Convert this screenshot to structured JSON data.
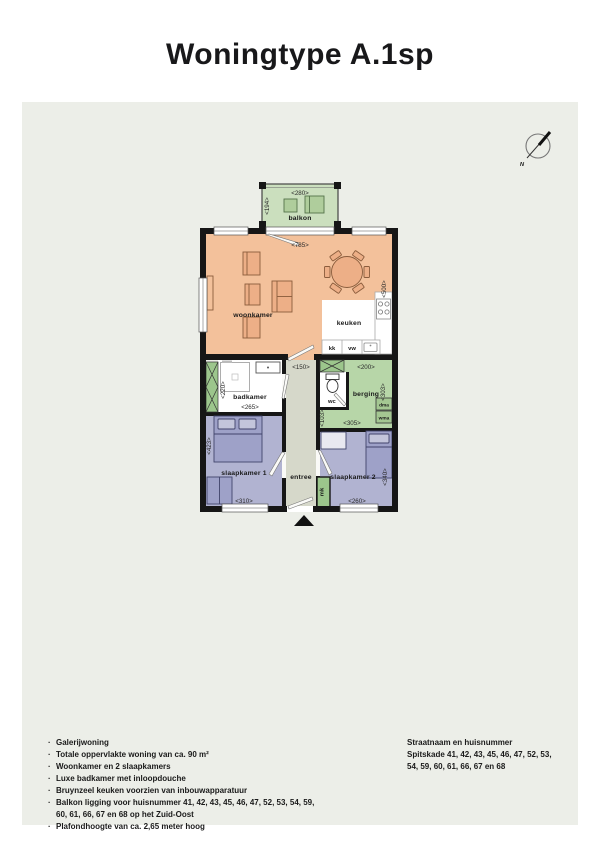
{
  "title": "Woningtype A.1sp",
  "compass": {
    "label": "N"
  },
  "colors": {
    "panel": "#ECEEE8",
    "wall": "#161616",
    "woonkamer": "#F3C19B",
    "balkon": "#CBDFBE",
    "berging": "#B7D6A8",
    "slaapkamer": "#B1B3D1",
    "entree": "#D6D8CA",
    "kast": "#9CC68C",
    "wit": "#FFFFFF"
  },
  "plan": {
    "rooms": {
      "balkon": {
        "label": "balkon",
        "dim_top": "<280>",
        "dim_left": "<194>"
      },
      "woonkamer": {
        "label": "woonkamer",
        "dim_top": "<785>",
        "dim_right": "<500>"
      },
      "keuken": {
        "label": "keuken",
        "kk": "kk",
        "vw": "vw"
      },
      "badkamer": {
        "label": "badkamer",
        "dim_left": "<220>",
        "dim_bottom": "<265>"
      },
      "entree": {
        "label": "entree",
        "dim_top": "<150>"
      },
      "wc": {
        "label": "wc"
      },
      "berging": {
        "label": "berging",
        "dim_top": "<200>",
        "dim_right": "<303>",
        "dim_left": "<103>",
        "dim_bottom": "<305>",
        "dma": "dma",
        "wma": "wma"
      },
      "slaapkamer1": {
        "label": "slaapkamer 1",
        "dim_left": "<423>",
        "dim_bottom": "<310>"
      },
      "slaapkamer2": {
        "label": "slaapkamer 2",
        "dim_right": "<340>",
        "dim_bottom": "<260>"
      },
      "mk": {
        "label": "mk"
      }
    }
  },
  "footer": {
    "bullet": "·",
    "features": [
      "Galerijwoning",
      "Totale oppervlakte woning van ca. 90 m²",
      "Woonkamer en 2 slaapkamers",
      "Luxe badkamer met inloopdouche",
      "Bruynzeel keuken voorzien van inbouwapparatuur",
      "Balkon ligging voor huisnummer 41, 42, 43, 45, 46, 47, 52, 53, 54, 59, 60, 61, 66, 67 en 68 op het Zuid-Oost",
      "Plafondhoogte van ca. 2,65 meter hoog"
    ],
    "address_title": "Straatnaam en huisnummer",
    "address_line1": "Spitskade 41, 42, 43, 45, 46, 47, 52, 53,",
    "address_line2": "54,  59, 60, 61, 66, 67 en 68"
  }
}
